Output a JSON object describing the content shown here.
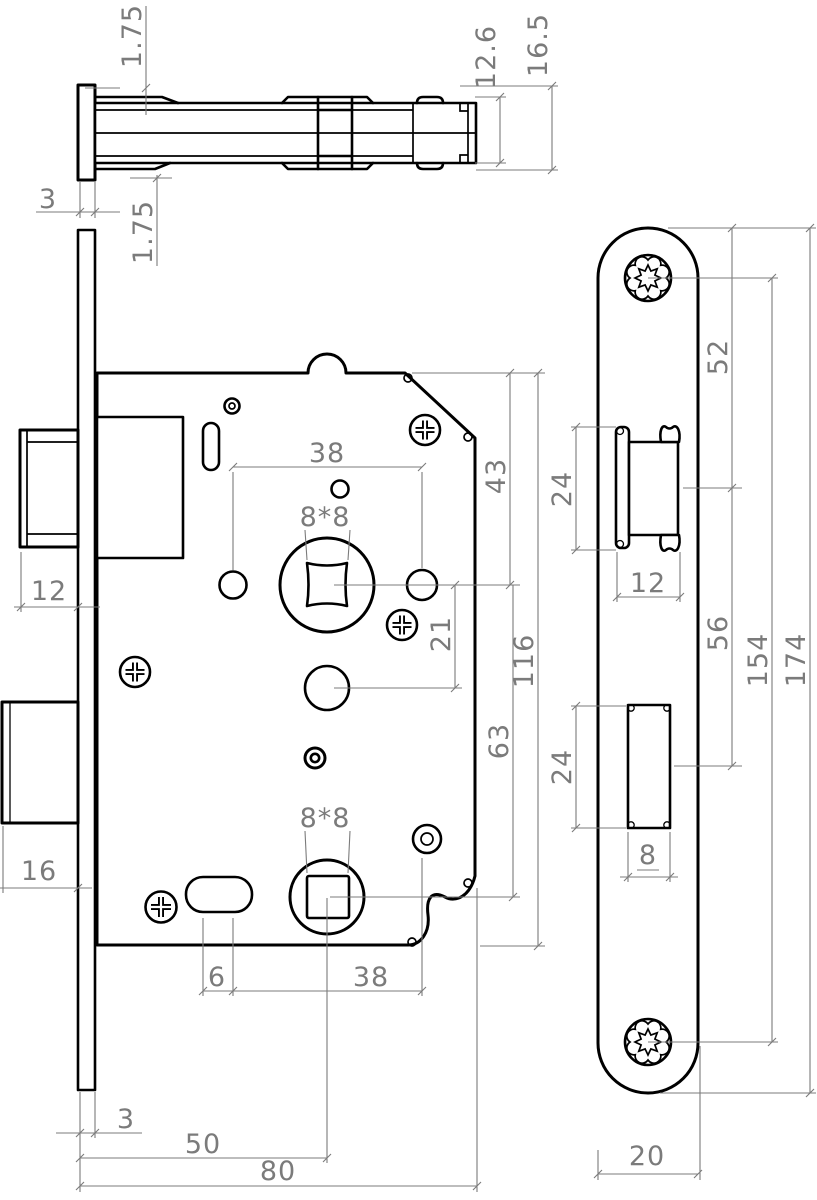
{
  "drawing": {
    "type": "mortise-lock-technical-drawing",
    "background_color": "#ffffff",
    "object_line_color": "#000000",
    "dimension_color": "#7b7b7b",
    "dims": {
      "top_view": {
        "flange_top": "1.75",
        "width_inner": "12.6",
        "width_outer": "16.5",
        "faceplate_thickness": "3",
        "flange_bottom": "1.75"
      },
      "front_view": {
        "hole_spacing_top": "38",
        "top_to_spindle": "43",
        "spindle_square_top": "8*8",
        "spindle_to_cylinder": "21",
        "case_height": "116",
        "spindle_spacing": "63",
        "latch_projection": "12",
        "deadbolt_projection": "16",
        "spindle_square_bottom": "8*8",
        "slot_length": "6",
        "hole_spacing_bottom": "38",
        "faceplate_thickness": "3",
        "backset": "50",
        "case_depth": "80"
      },
      "side_view": {
        "top_to_latch": "52",
        "latch_height": "24",
        "latch_width": "12",
        "latch_to_deadbolt": "56",
        "screw_spacing": "154",
        "faceplate_length": "174",
        "deadbolt_height": "24",
        "deadbolt_width": "8",
        "faceplate_width": "20"
      }
    }
  }
}
